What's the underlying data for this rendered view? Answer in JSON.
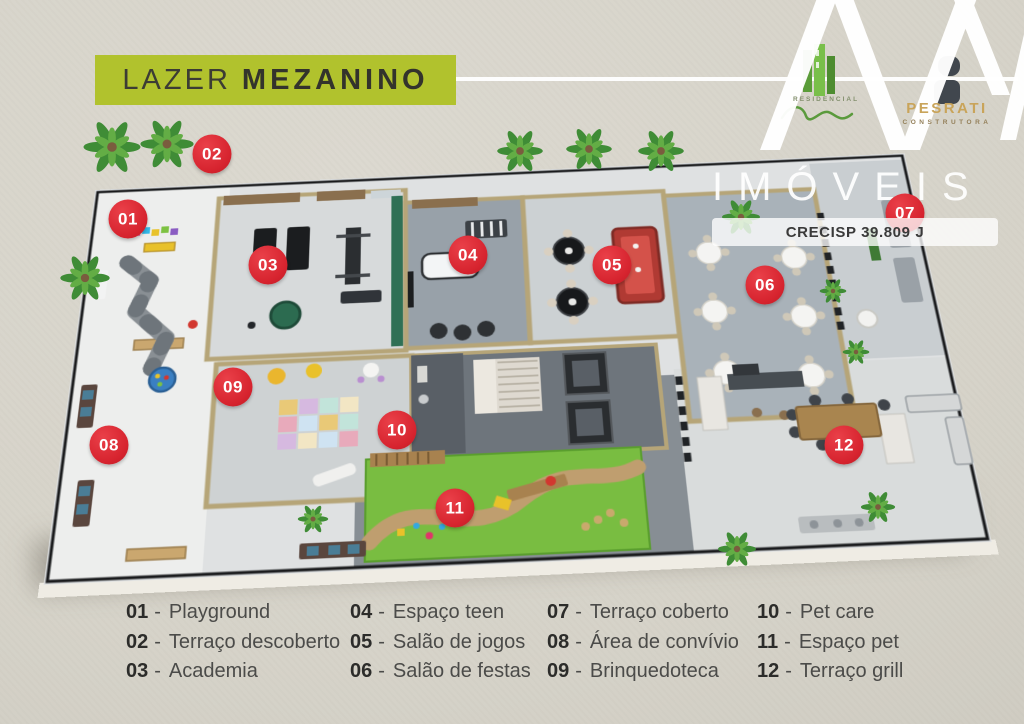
{
  "header": {
    "title_regular": "LAZER",
    "title_bold": "MEZANINO"
  },
  "branding": {
    "watermark_text": "IMÓVEIS",
    "crecisp_badge": "CRECISP 39.809 J",
    "residencial_label": "RESIDENCIAL",
    "builder_name": "PESRATI",
    "builder_label": "CONSTRUTORA"
  },
  "colors": {
    "banner_lime": "#b1c22d",
    "marker_red": "#d6232e",
    "background_beige": "#d6d3c9",
    "logo_gold": "#c9a45a",
    "logo_green": "#6aab3c",
    "grass_green": "#79bd41"
  },
  "markers": [
    {
      "number": "01",
      "x": 128,
      "y": 219
    },
    {
      "number": "02",
      "x": 212,
      "y": 154
    },
    {
      "number": "03",
      "x": 268,
      "y": 265
    },
    {
      "number": "04",
      "x": 468,
      "y": 255
    },
    {
      "number": "05",
      "x": 612,
      "y": 265
    },
    {
      "number": "06",
      "x": 765,
      "y": 285
    },
    {
      "number": "07",
      "x": 905,
      "y": 213
    },
    {
      "number": "08",
      "x": 109,
      "y": 445
    },
    {
      "number": "09",
      "x": 233,
      "y": 387
    },
    {
      "number": "10",
      "x": 397,
      "y": 430
    },
    {
      "number": "11",
      "x": 455,
      "y": 508
    },
    {
      "number": "12",
      "x": 844,
      "y": 445
    }
  ],
  "legend": {
    "separator": "-",
    "items": [
      {
        "number": "01",
        "label": "Playground"
      },
      {
        "number": "02",
        "label": "Terraço descoberto"
      },
      {
        "number": "03",
        "label": "Academia"
      },
      {
        "number": "04",
        "label": "Espaço teen"
      },
      {
        "number": "05",
        "label": "Salão de jogos"
      },
      {
        "number": "06",
        "label": "Salão de festas"
      },
      {
        "number": "07",
        "label": "Terraço coberto"
      },
      {
        "number": "08",
        "label": "Área de convívio"
      },
      {
        "number": "09",
        "label": "Brinquedoteca"
      },
      {
        "number": "10",
        "label": "Pet care"
      },
      {
        "number": "11",
        "label": "Espaço pet"
      },
      {
        "number": "12",
        "label": "Terraço grill"
      }
    ]
  }
}
